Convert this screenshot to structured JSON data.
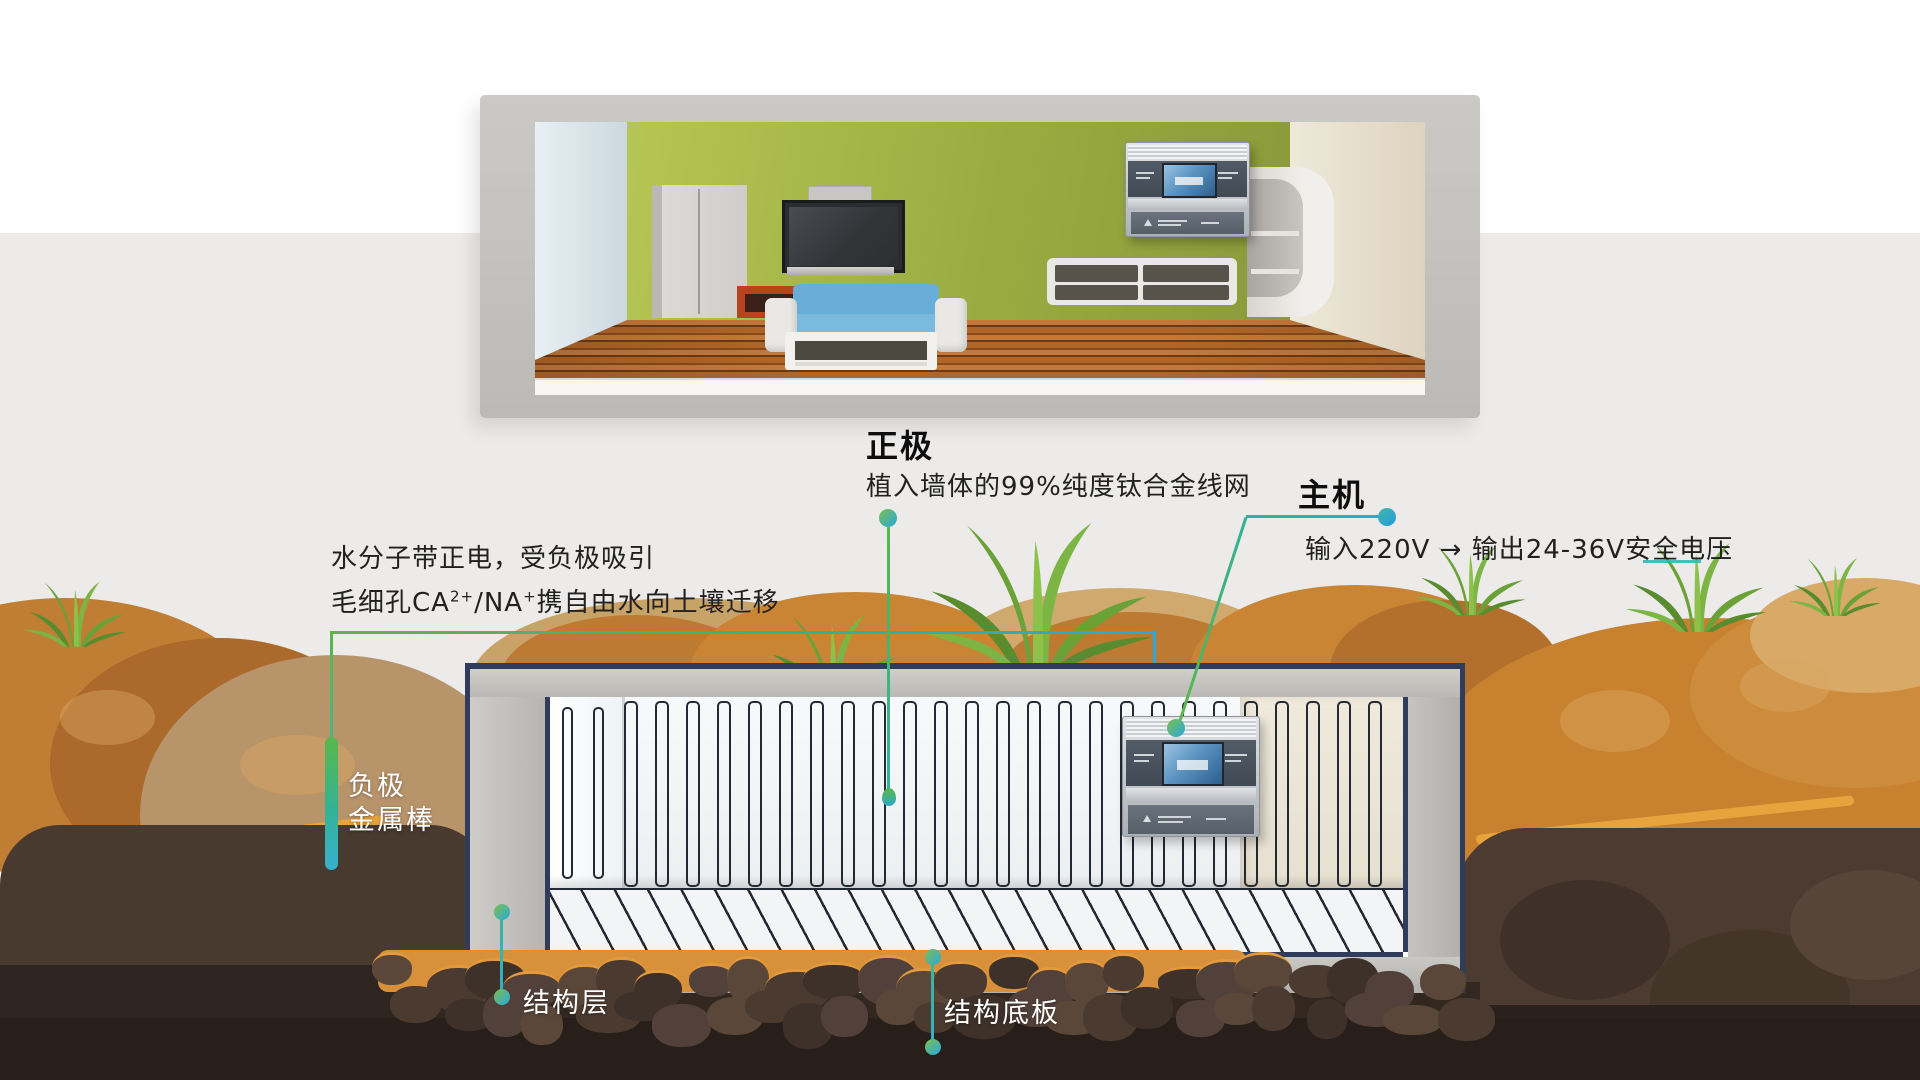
{
  "diagram": {
    "positive_electrode": {
      "title": "正极",
      "desc": "植入墙体的99%纯度钛合金线网"
    },
    "host_unit": {
      "title": "主机",
      "desc": "输入220V → 输出24-36V安全电压"
    },
    "water_migration": {
      "line1": "水分子带正电，受负极吸引",
      "line2_prefix": "毛细孔CA",
      "line2_sup1": "2+",
      "line2_mid": "/NA",
      "line2_sup2": "+",
      "line2_suffix": "携自由水向土壤迁移"
    },
    "negative_electrode": {
      "line1": "负极",
      "line2": "金属棒"
    },
    "structure_layer_label": "结构层",
    "base_plate_label": "结构底板"
  },
  "colors": {
    "leader_green": "#5fb449",
    "leader_teal": "#2fb2a0",
    "leader_blue": "#29a8df",
    "soil_orange": "#c8812f",
    "grass_green": "#76ab3c",
    "wall_green": "#9aab41",
    "navy_outline": "#303c5c",
    "wood_floor": "#b06628"
  }
}
